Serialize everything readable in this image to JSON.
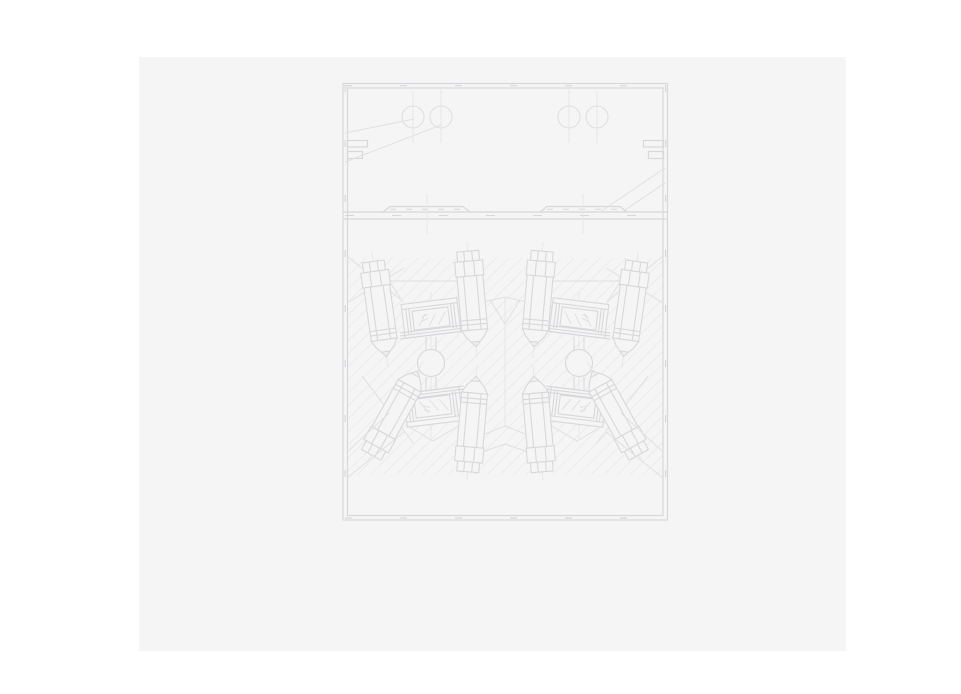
{
  "page": {
    "background": "#ffffff"
  },
  "panel": {
    "background": "#f5f5f6"
  },
  "drawing": {
    "kind": "engineering-cross-section",
    "colors": {
      "line": "#e0e0e2",
      "line_strong": "#d8d8da",
      "centerline": "#e8e8ea",
      "hatch": "#ececee"
    }
  }
}
